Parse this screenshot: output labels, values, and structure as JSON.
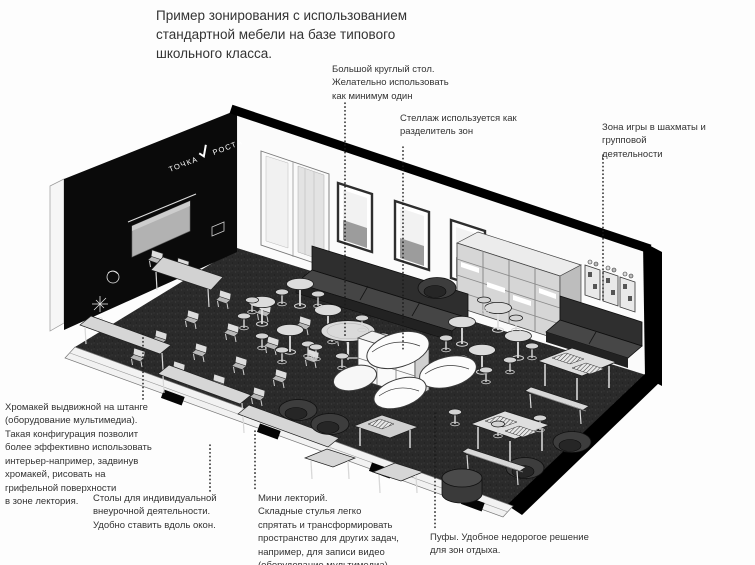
{
  "title": "Пример зонирования с использованием\nстандартной мебели на базе типового\nшкольного класса.",
  "colors": {
    "wall": "#0a0a0a",
    "floor": "#2a2a2a",
    "text": "#333333",
    "paper": "#fdfdfd"
  },
  "illustration": {
    "logo": {
      "word1": "ТОЧКА",
      "word2": "РОСТА"
    },
    "zones": [
      "мини лекторий",
      "зона отдыха",
      "зона игры в шахматы"
    ]
  },
  "callouts": {
    "big_round_table": "Большой круглый стол.\nЖелательно использовать\nкак минимум один",
    "shelf_divider": "Стеллаж используется как\nразделитель зон",
    "chess_zone": "Зона игры в шахматы и групповой\nдеятельности",
    "chromakey": "Хромакей выдвижной на штанге\n(оборудование мультимедиа).\nТакая конфигурация позволит\nболее эффективно использовать\nинтерьер-например, задвинув\nхромакей, рисовать на\nгрифельной поверхности\nв зоне лектория.",
    "individual_desks": "Столы для индивидуальной\nвнеурочной деятельности.\nУдобно ставить вдоль окон.",
    "mini_lecture": "Мини лекторий.\nСкладные стулья легко\nспрятать и трансформировать\nпространство для других задач,\nнапример, для записи видео\n(оборудование мультимедиа).",
    "poufs": "Пуфы. Удобное недорогое решение\nдля зон отдыха."
  }
}
